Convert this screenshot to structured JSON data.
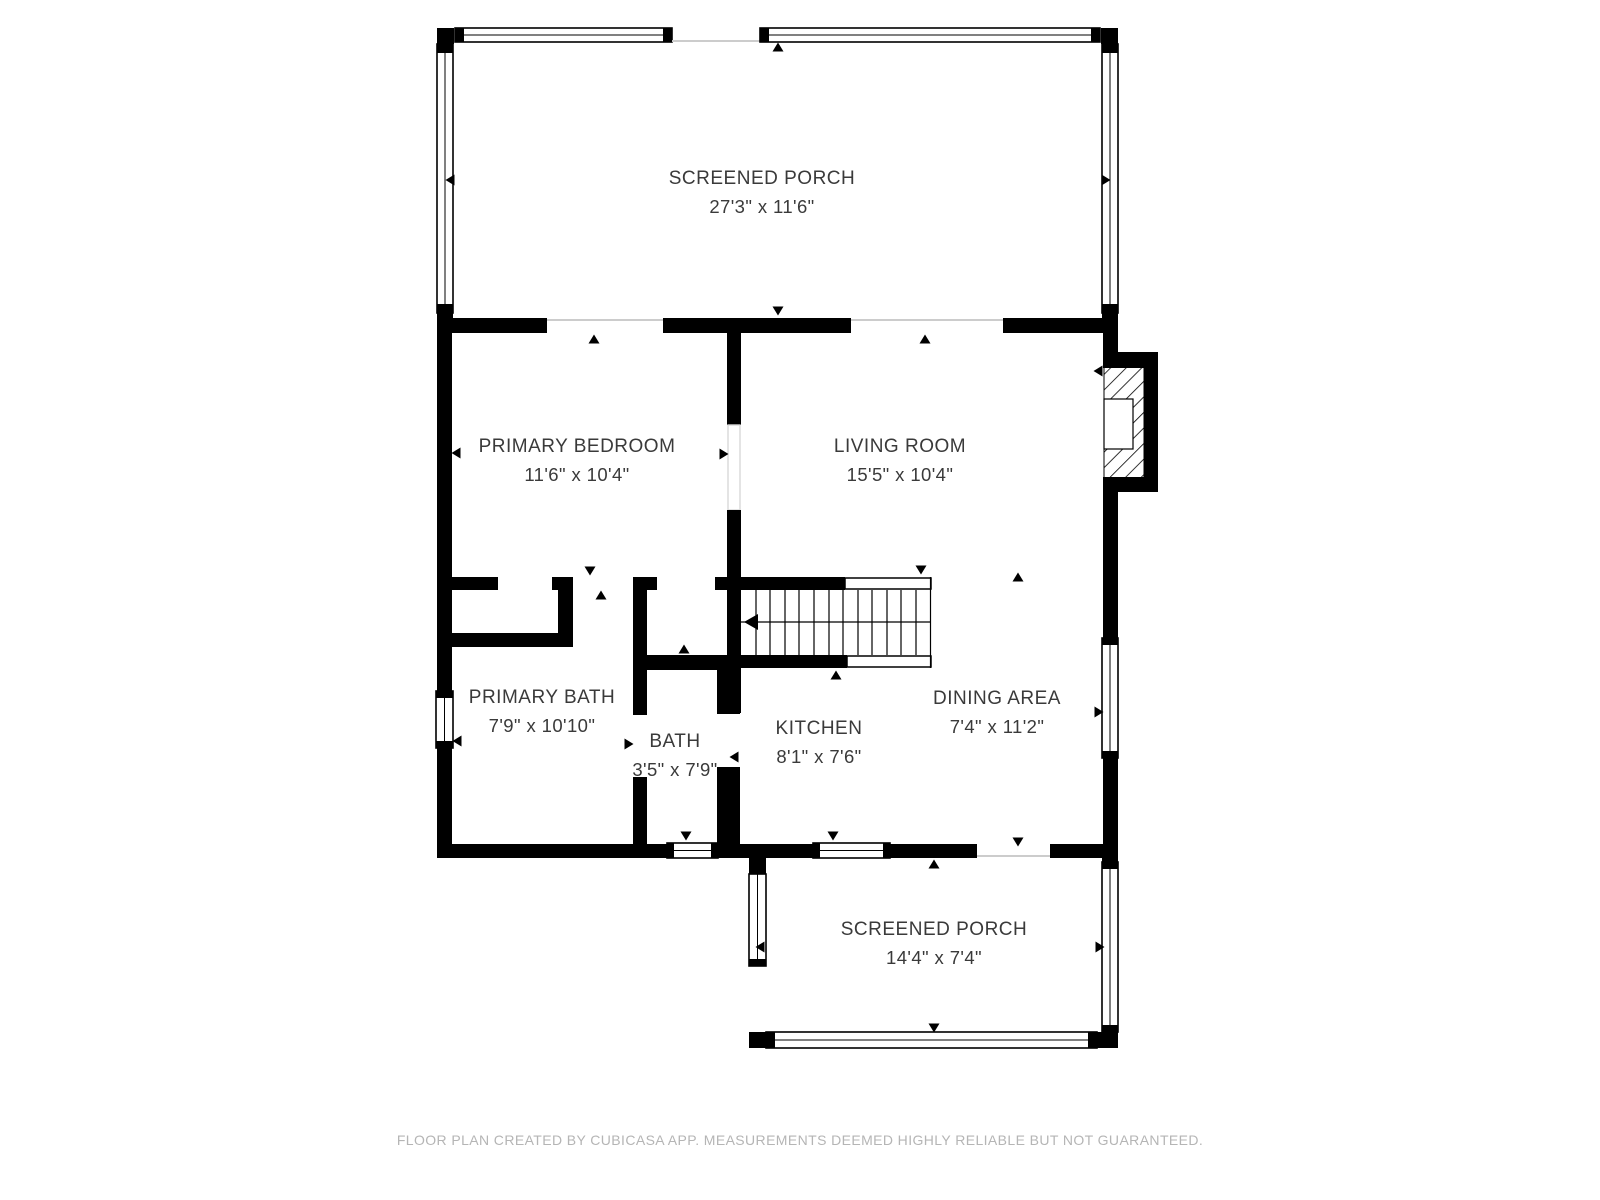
{
  "rooms": [
    {
      "key": "screened-porch-top",
      "name": "SCREENED PORCH",
      "dimensions": "27'3\" x 11'6\""
    },
    {
      "key": "primary-bedroom",
      "name": "PRIMARY BEDROOM",
      "dimensions": "11'6\" x 10'4\""
    },
    {
      "key": "living-room",
      "name": "LIVING ROOM",
      "dimensions": "15'5\" x 10'4\""
    },
    {
      "key": "primary-bath",
      "name": "PRIMARY BATH",
      "dimensions": "7'9\" x 10'10\""
    },
    {
      "key": "bath",
      "name": "BATH",
      "dimensions": "3'5\" x 7'9\""
    },
    {
      "key": "kitchen",
      "name": "KITCHEN",
      "dimensions": "8'1\" x 7'6\""
    },
    {
      "key": "dining-area",
      "name": "DINING AREA",
      "dimensions": "7'4\" x 11'2\""
    },
    {
      "key": "screened-porch-bottom",
      "name": "SCREENED PORCH",
      "dimensions": "14'4\" x 7'4\""
    }
  ],
  "footer": {
    "text": "FLOOR PLAN CREATED BY CUBICASA APP. MEASUREMENTS DEEMED HIGHLY RELIABLE BUT NOT GUARANTEED."
  },
  "colors": {
    "wall": "#000000",
    "background": "#ffffff",
    "room_label": "#3a3a3a",
    "footer_text": "#b5b5b5",
    "threshold": "#cccccc"
  }
}
